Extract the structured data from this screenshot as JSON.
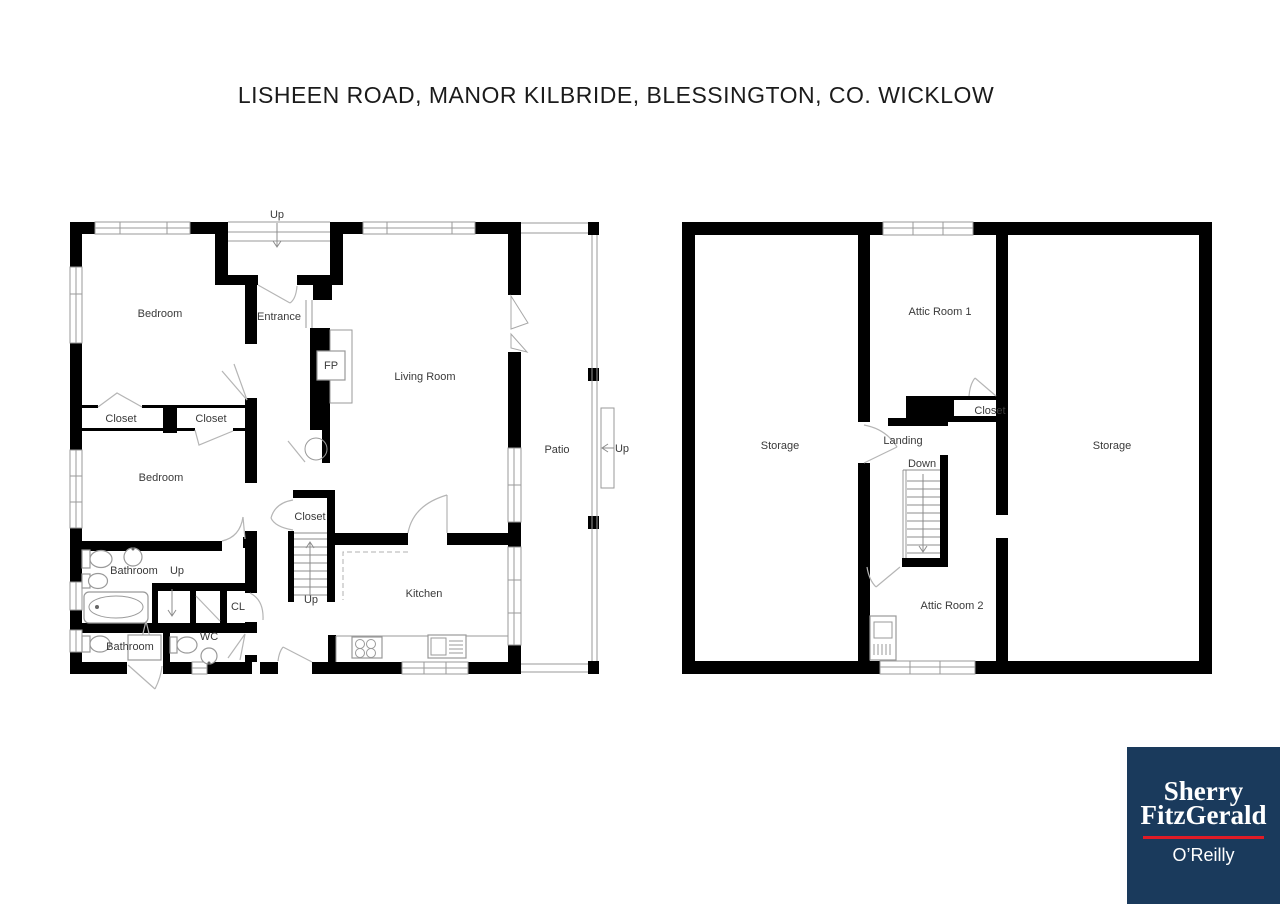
{
  "title": "LISHEEN ROAD, MANOR KILBRIDE, BLESSINGTON, CO. WICKLOW",
  "ground_floor": {
    "rooms": {
      "up_porch": "Up",
      "bedroom1": "Bedroom",
      "entrance": "Entrance",
      "fp": "FP",
      "living_room": "Living Room",
      "closet1": "Closet",
      "closet2": "Closet",
      "bedroom2": "Bedroom",
      "patio": "Patio",
      "up_patio": "Up",
      "closet3": "Closet",
      "bathroom1": "Bathroom",
      "up_bathroom": "Up",
      "cl": "CL",
      "up_stairs": "Up",
      "kitchen": "Kitchen",
      "bathroom2": "Bathroom",
      "wc": "WC"
    }
  },
  "attic_floor": {
    "rooms": {
      "attic_room_1": "Attic Room 1",
      "storage_left": "Storage",
      "storage_right": "Storage",
      "closet": "Closet",
      "landing": "Landing",
      "down": "Down",
      "attic_room_2": "Attic Room 2"
    }
  },
  "logo": {
    "line1": "Sherry",
    "line2": "FitzGerald",
    "line3": "O’Reilly",
    "background": "#1a3a5c",
    "divider": "#e01b26",
    "text": "#ffffff"
  },
  "colors": {
    "wall": "#000000",
    "background": "#ffffff",
    "label": "#3a3a3a"
  }
}
